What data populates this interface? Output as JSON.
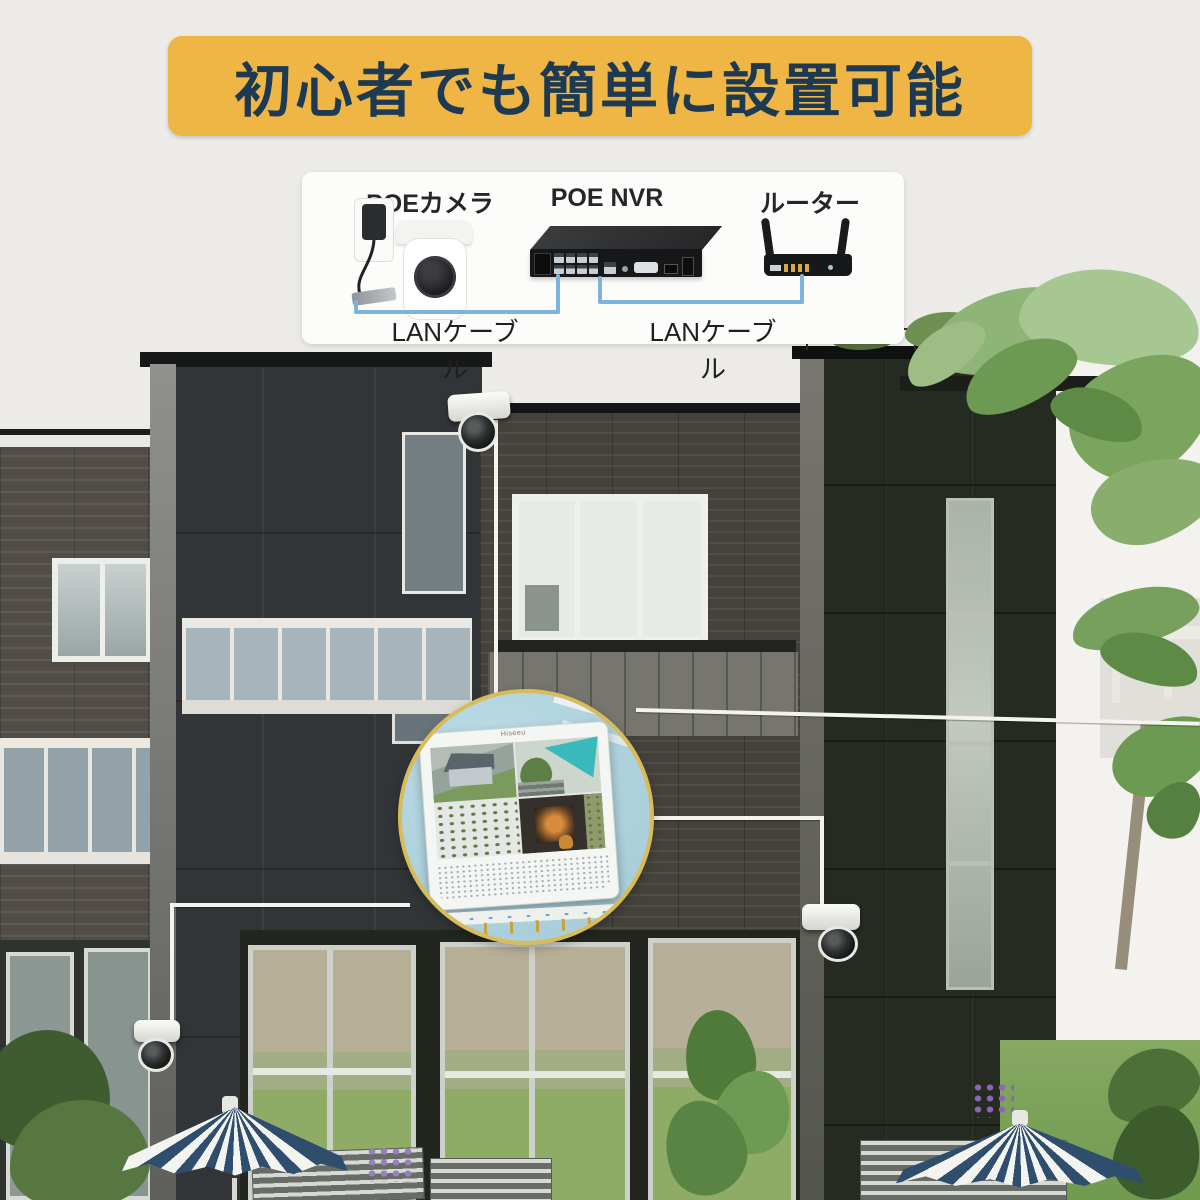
{
  "banner": {
    "title": "初心者でも簡単に設置可能"
  },
  "diagram": {
    "camera_label": "POEカメラ",
    "nvr_label": "POE NVR",
    "router_label": "ルーター",
    "lan_label_left": "LANケーブル",
    "lan_label_right": "LANケーブル"
  },
  "monitor": {
    "brand": "Hiseeu"
  },
  "colors": {
    "page_bg": "#ECEBE8",
    "banner_bg": "#F0B645",
    "banner_text": "#1D3A52",
    "panel_bg": "#FCFCFB",
    "label_text": "#262626",
    "cable_blue": "#7FB3D9",
    "ring_gold": "#D8BC5A",
    "inset_blue": "#AACFDB"
  }
}
